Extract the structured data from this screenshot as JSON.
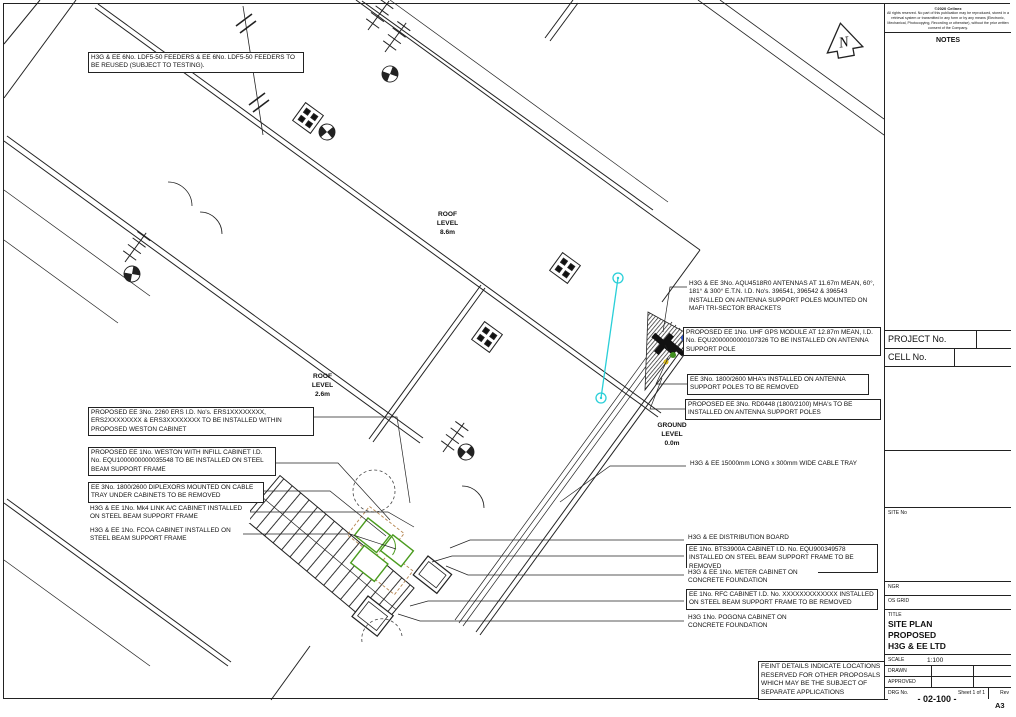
{
  "page": {
    "paper_size": "A3"
  },
  "north_arrow": {
    "label": "N"
  },
  "levels": {
    "roof_main": {
      "l1": "ROOF",
      "l2": "LEVEL",
      "l3": "8.6m"
    },
    "roof_low": {
      "l1": "ROOF",
      "l2": "LEVEL",
      "l3": "2.6m"
    },
    "ground": {
      "l1": "GROUND",
      "l2": "LEVEL",
      "l3": "0.0m"
    }
  },
  "annotations": {
    "feeders": {
      "text": "H3G & EE 6No. LDF5-50 FEEDERS & EE 6No. LDF5-50 FEEDERS TO BE REUSED (SUBJECT TO TESTING)."
    },
    "antennas": {
      "text": "H3G & EE 3No. AQU4518R0 ANTENNAS AT 11.67m MEAN, 60°, 181° & 300° E.T.N. I.D. No's. 396541, 396542 & 396543 INSTALLED ON ANTENNA SUPPORT POLES MOUNTED ON MAFI TRI-SECTOR BRACKETS"
    },
    "gps_module": {
      "text": "PROPOSED EE 1No. UHF GPS MODULE AT 12.87m MEAN, I.D. No. EQU2000000000107326 TO BE INSTALLED ON ANTENNA SUPPORT POLE"
    },
    "mha_removed": {
      "text": "EE 3No. 1800/2600 MHA's INSTALLED ON ANTENNA SUPPORT POLES TO BE REMOVED"
    },
    "mha_proposed": {
      "text": "PROPOSED EE 3No. RD0448 (1800/2100) MHA's TO BE INSTALLED ON ANTENNA SUPPORT POLES"
    },
    "ers_units": {
      "text": "PROPOSED EE 3No. 2260 ERS I.D. No's. ERS1XXXXXXXX, ERS2XXXXXXXX & ERS3XXXXXXXX TO BE INSTALLED WITHIN PROPOSED WESTON CABINET"
    },
    "weston_cabinet": {
      "text": "PROPOSED EE 1No. WESTON WITH INFILL CABINET I.D. No. EQU1000000000035548 TO BE INSTALLED ON STEEL BEAM SUPPORT FRAME"
    },
    "diplexors": {
      "text": "EE 3No. 1800/2600 DIPLEXORS MOUNTED ON CABLE TRAY UNDER CABINETS TO BE REMOVED"
    },
    "mk4_link": {
      "text": "H3G & EE 1No. Mk4 LINK A/C CABINET INSTALLED ON STEEL BEAM SUPPORT FRAME"
    },
    "fcoa": {
      "text": "H3G & EE 1No. FCOA CABINET INSTALLED ON STEEL BEAM SUPPORT FRAME"
    },
    "cable_tray": {
      "text": "H3G & EE 15000mm LONG x 300mm WIDE CABLE TRAY"
    },
    "distribution_board": {
      "text": "H3G & EE DISTRIBUTION BOARD"
    },
    "bts3900a": {
      "text": "EE 1No. BTS3900A CABINET I.D. No. EQU900349578 INSTALLED ON STEEL BEAM SUPPORT FRAME TO BE REMOVED"
    },
    "meter_cabinet": {
      "text": "H3G & EE 1No. METER CABINET ON CONCRETE FOUNDATION"
    },
    "rfc_cabinet": {
      "text": "EE 1No. RFC CABINET I.D. No. XXXXXXXXXXXXX INSTALLED ON STEEL BEAM SUPPORT FRAME TO BE REMOVED"
    },
    "pogona": {
      "text": "H3G 1No. POGONA CABINET ON CONCRETE FOUNDATION"
    },
    "feint_note": {
      "text": "FEINT DETAILS INDICATE LOCATIONS RESERVED FOR OTHER PROPOSALS WHICH MAY BE THE SUBJECT OF SEPARATE APPLICATIONS"
    }
  },
  "titleblock": {
    "copyright_line1": "©2020 Cellnex",
    "copyright_body": "All rights reserved. No part of this publication may be reproduced, stored in a retrieval system or transmitted in any form or by any means (Electronic, Mechanical, Photocopying, Recording or otherwise), without the prior written consent of the Company.",
    "notes_label": "NOTES",
    "project_no_label": "PROJECT No.",
    "cell_no_label": "CELL No.",
    "site_no_label": "SITE No",
    "ngr_label": "NGR",
    "os_grid_label": "OS GRID",
    "title_label": "TITLE",
    "title_lines": {
      "l1": "SITE PLAN",
      "l2": "PROPOSED",
      "l3": "H3G & EE LTD"
    },
    "scale_label": "SCALE",
    "scale_value": "1:100",
    "drawn_label": "DRAWN",
    "approved_label": "APPROVED",
    "drg_no_label": "DRG No.",
    "sheet_label": "Sheet",
    "sheet_value": "1",
    "of_label": "of",
    "of_value": "1",
    "rev_label": "Rev",
    "drg_no_value": "- 02-100 -"
  },
  "colors": {
    "line": "#222222",
    "proposed_green": "#4a9b1e",
    "route_cyan": "#29cfd8",
    "feint_tan": "#b5854f"
  }
}
